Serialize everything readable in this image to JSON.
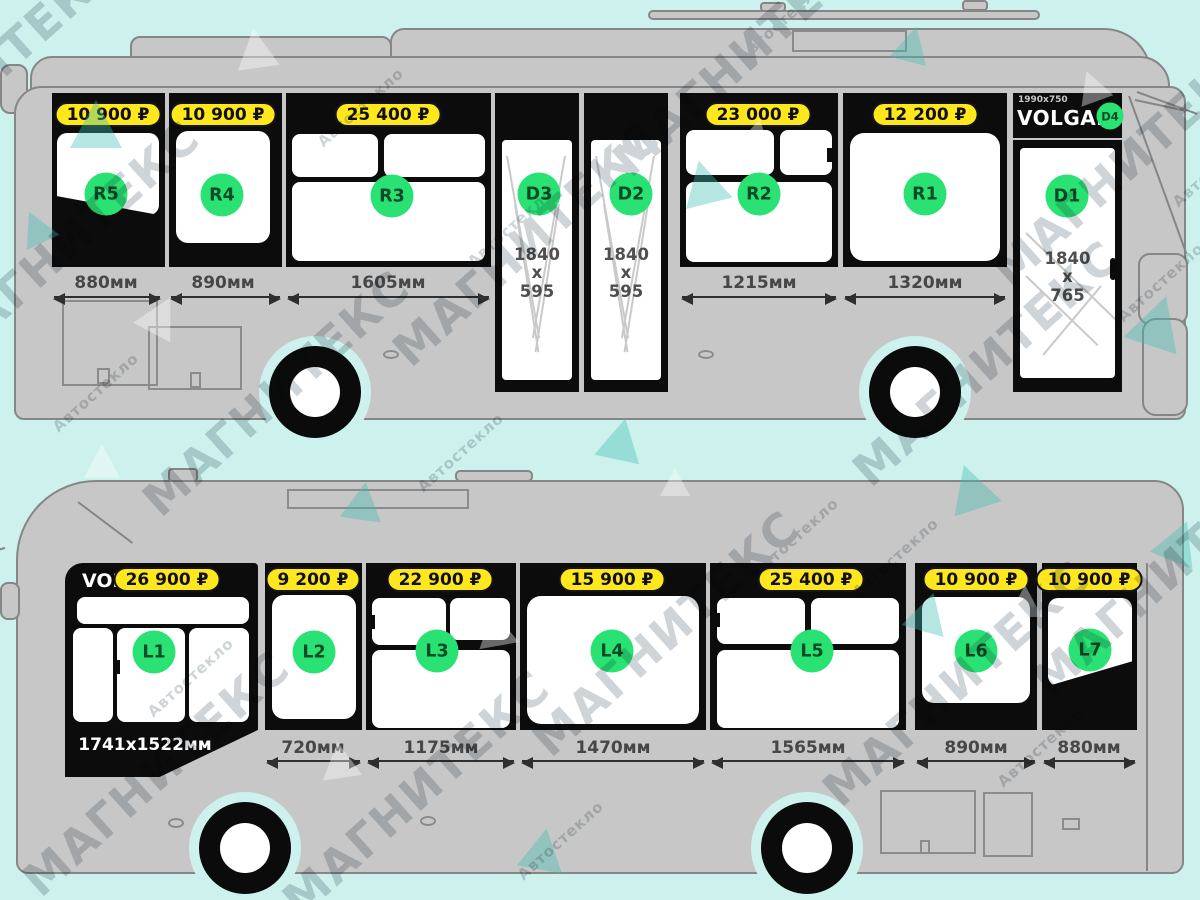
{
  "watermark": {
    "brand": "МАГНИТЕКС",
    "sub": "Автостекло"
  },
  "top_bus": {
    "r5": {
      "label": "R5",
      "price": "10 900 ₽",
      "dim": "880мм"
    },
    "r4": {
      "label": "R4",
      "price": "10 900 ₽",
      "dim": "890мм"
    },
    "r3": {
      "label": "R3",
      "price": "25 400 ₽",
      "dim": "1605мм"
    },
    "d3": {
      "label": "D3",
      "size": "1840\nx\n595"
    },
    "d2": {
      "label": "D2",
      "size": "1840\nx\n595"
    },
    "r2": {
      "label": "R2",
      "price": "23 000 ₽",
      "dim": "1215мм"
    },
    "r1": {
      "label": "R1",
      "price": "12 200 ₽",
      "dim": "1320мм"
    },
    "d1": {
      "label": "D1",
      "size": "1840\nx\n765",
      "header_size": "1990x750",
      "header_brand": "VOLGAB",
      "header_badge": "D4"
    }
  },
  "bottom_bus": {
    "l1": {
      "label": "L1",
      "price": "26 900 ₽",
      "header_brand": "VOL",
      "size": "1741x1522мм"
    },
    "l2": {
      "label": "L2",
      "price": "9 200 ₽",
      "dim": "720мм"
    },
    "l3": {
      "label": "L3",
      "price": "22 900 ₽",
      "dim": "1175мм"
    },
    "l4": {
      "label": "L4",
      "price": "15 900 ₽",
      "dim": "1470мм"
    },
    "l5": {
      "label": "L5",
      "price": "25 400 ₽",
      "dim": "1565мм"
    },
    "l6": {
      "label": "L6",
      "price": "10 900 ₽",
      "dim": "890мм"
    },
    "l7": {
      "label": "L7",
      "price": "10 900 ₽",
      "dim": "880мм"
    }
  }
}
